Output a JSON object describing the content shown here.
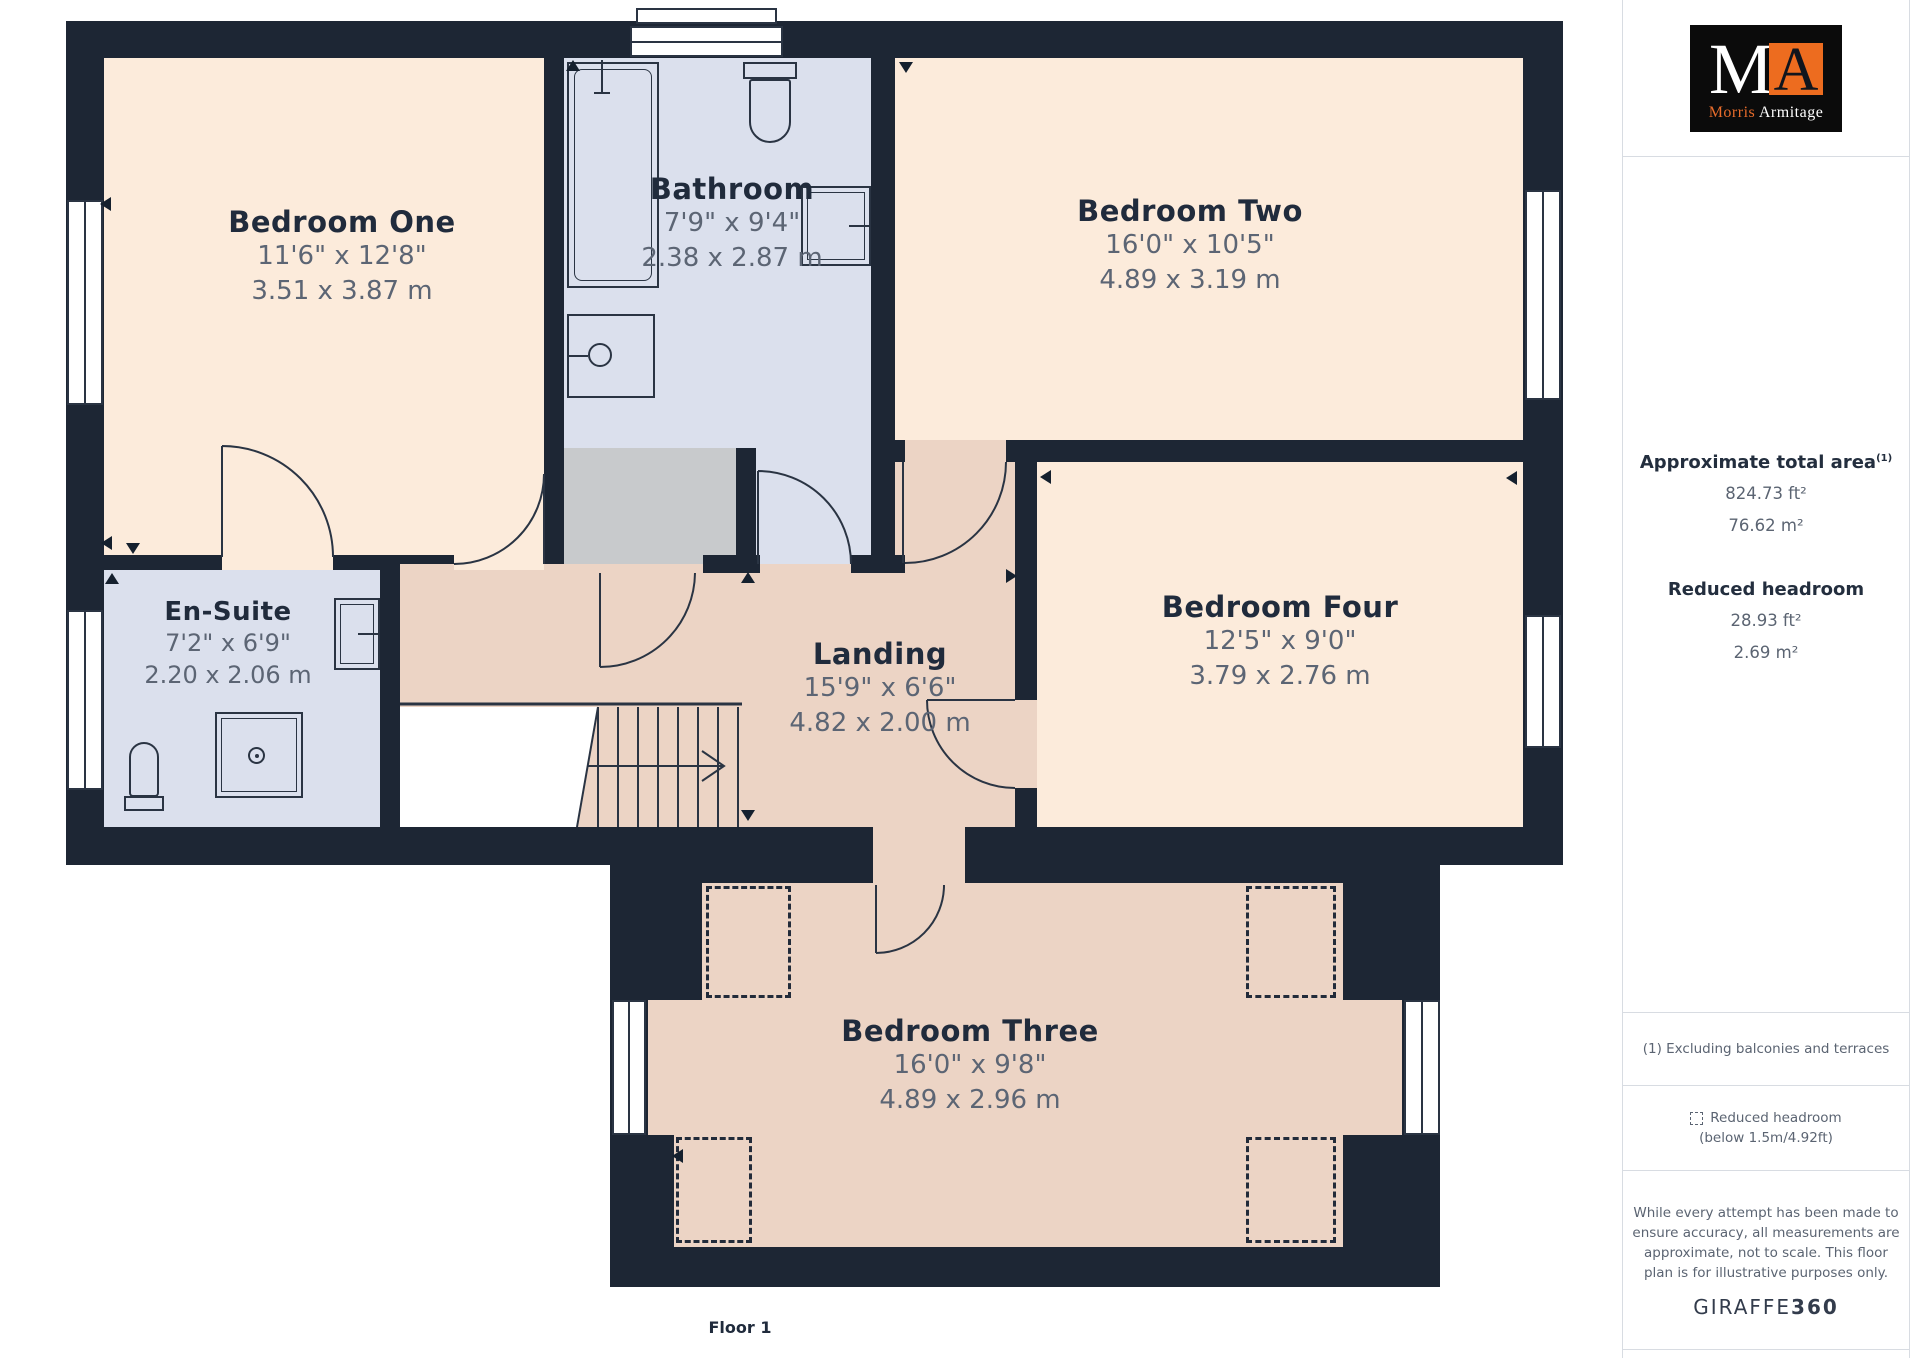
{
  "floorplan": {
    "floor_label": "Floor 1",
    "rooms": [
      {
        "name": "Bedroom One",
        "dims_imperial": "11'6\" x 12'8\"",
        "dims_metric": "3.51 x 3.87 m"
      },
      {
        "name": "Bathroom",
        "dims_imperial": "7'9\" x 9'4\"",
        "dims_metric": "2.38 x 2.87 m"
      },
      {
        "name": "Bedroom Two",
        "dims_imperial": "16'0\" x 10'5\"",
        "dims_metric": "4.89 x 3.19 m"
      },
      {
        "name": "En-Suite",
        "dims_imperial": "7'2\" x 6'9\"",
        "dims_metric": "2.20 x 2.06 m"
      },
      {
        "name": "Landing",
        "dims_imperial": "15'9\" x 6'6\"",
        "dims_metric": "4.82 x 2.00 m"
      },
      {
        "name": "Bedroom Four",
        "dims_imperial": "12'5\" x 9'0\"",
        "dims_metric": "3.79 x 2.76 m"
      },
      {
        "name": "Bedroom Three",
        "dims_imperial": "16'0\" x 9'8\"",
        "dims_metric": "4.89 x 2.96 m"
      }
    ],
    "colors": {
      "wall": "#1d2634",
      "bedroom_floor": "#fcebdb",
      "bathroom_floor": "#dbe0ed",
      "landing_floor": "#ecd4c5",
      "storage_floor": "#c8cacc",
      "accent_orange": "#ed6c1f"
    }
  },
  "sidebar": {
    "logo": {
      "letter_m": "M",
      "letter_a": "A",
      "name_first": "Morris",
      "name_last": "Armitage"
    },
    "total_area": {
      "title": "Approximate total area",
      "superscript": "(1)",
      "imperial": "824.73 ft²",
      "metric": "76.62 m²"
    },
    "reduced_headroom": {
      "title": "Reduced headroom",
      "imperial": "28.93 ft²",
      "metric": "2.69 m²"
    },
    "footnote_area": "(1) Excluding balconies and terraces",
    "legend": {
      "line1": "Reduced headroom",
      "line2": "(below 1.5m/4.92ft)"
    },
    "disclaimer_lines": [
      "While every attempt has been made to",
      "ensure accuracy, all measurements are",
      "approximate, not to scale. This floor",
      "plan is for illustrative purposes only."
    ],
    "brand": {
      "giraffe": "GIRAFFE",
      "threesixty": "360"
    }
  }
}
